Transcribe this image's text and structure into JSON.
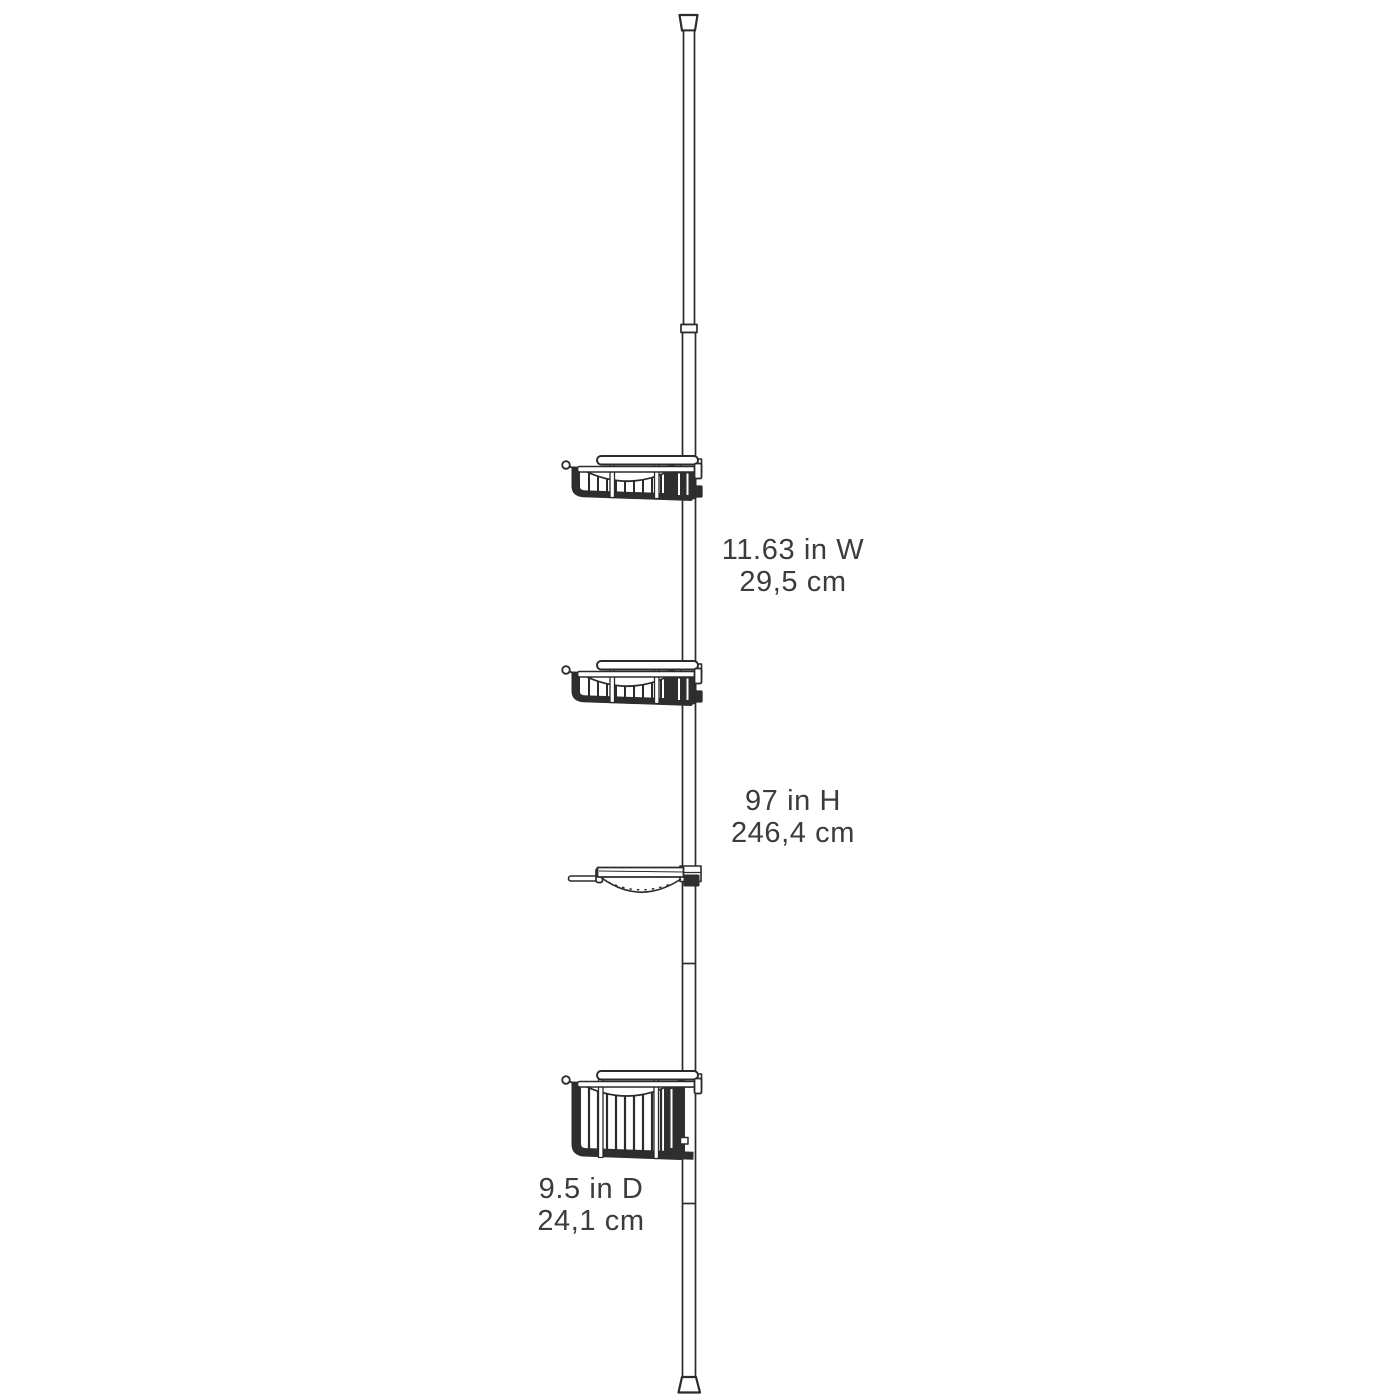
{
  "page": {
    "background_color": "#ffffff"
  },
  "diagram": {
    "line_color": "#2b2b2b",
    "dark_fill_color": "#2e2e2e",
    "parts": [
      "top-cap",
      "tension-pole",
      "pole-collar",
      "shallow-basket-tier-1",
      "shallow-basket-tier-2",
      "soap-dish-tier-3",
      "deep-basket-tier-4",
      "bottom-cap"
    ]
  },
  "labels": {
    "width": {
      "imperial": "11.63 in W",
      "metric": "29,5 cm"
    },
    "height": {
      "imperial": "97 in H",
      "metric": "246,4 cm"
    },
    "depth": {
      "imperial": "9.5 in D",
      "metric": "24,1 cm"
    }
  }
}
